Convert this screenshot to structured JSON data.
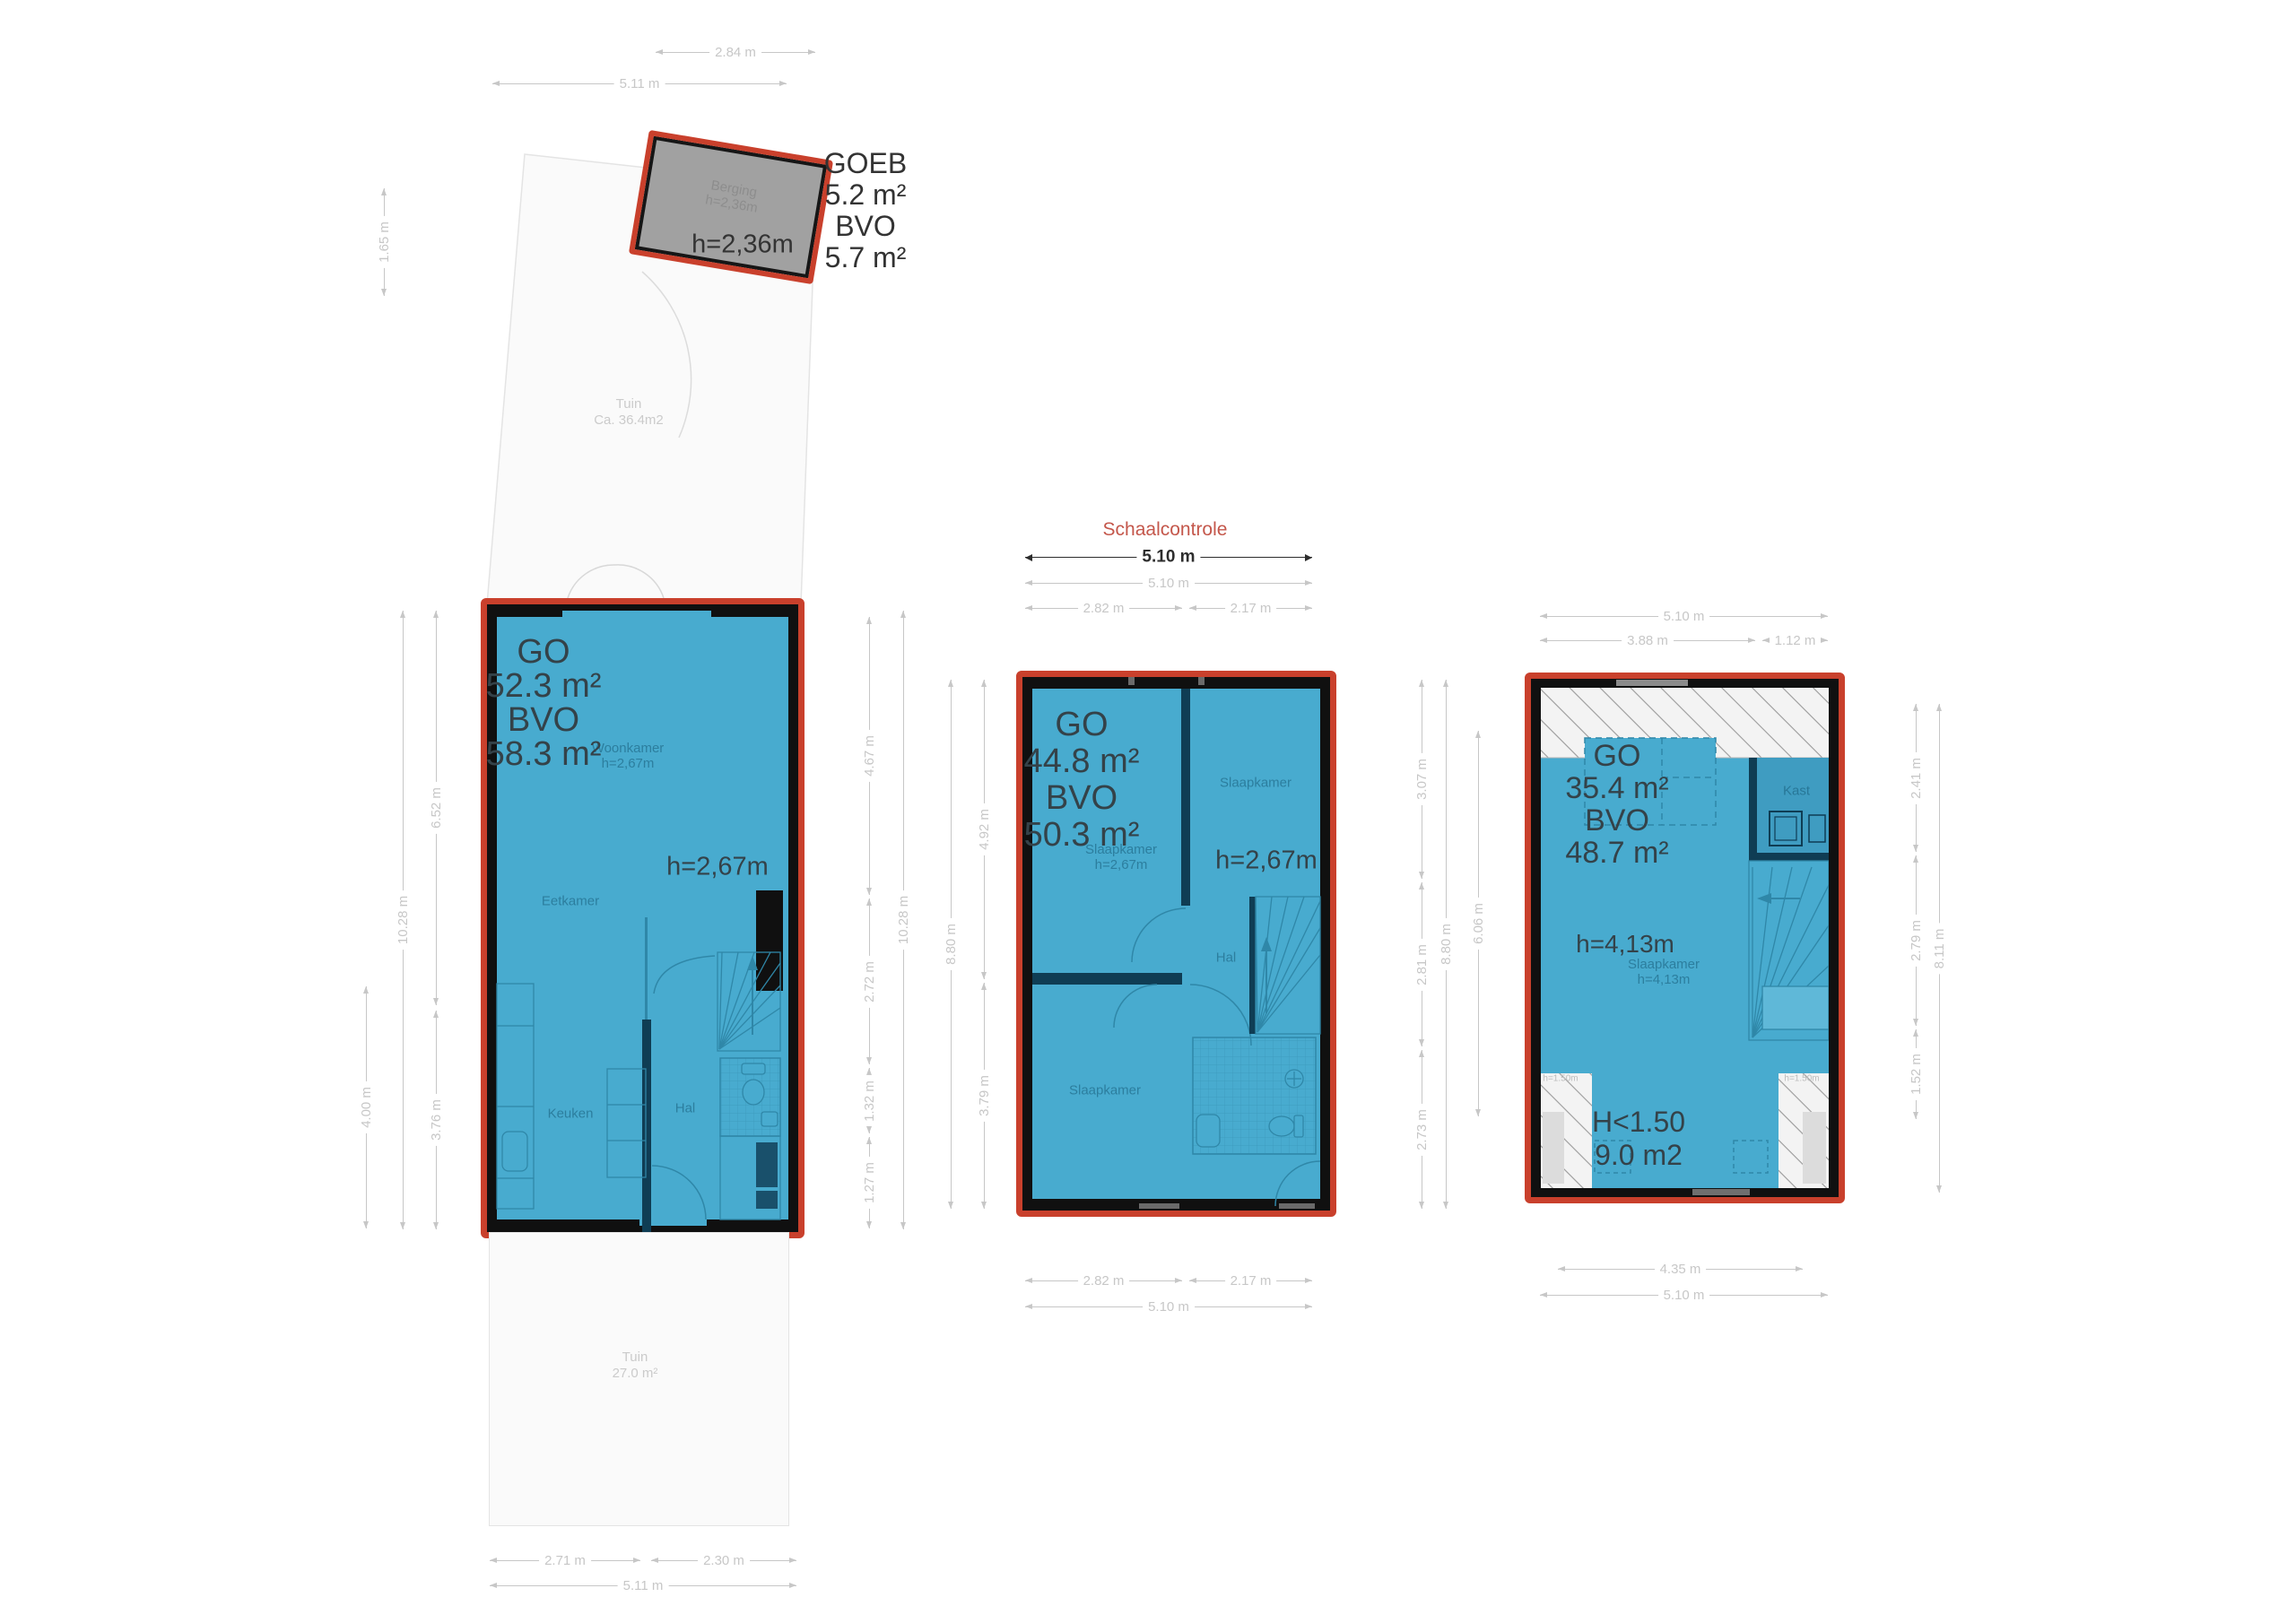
{
  "colors": {
    "plan_blue": "#48abcf",
    "outline_red": "#c9402c",
    "wall_black": "#101010",
    "dim_gray": "#c7c7c7",
    "label_dark": "#344249",
    "schaal_red": "#c4574b"
  },
  "shed": {
    "goeb_label": "GOEB",
    "goeb_area": "5.2 m²",
    "bvo_label": "BVO",
    "bvo_area": "5.7 m²",
    "height": "h=2,36m",
    "room_name": "Berging",
    "room_height": "h=2,36m"
  },
  "gardens": {
    "top_name": "Tuin",
    "top_area": "Ca. 36.4m2",
    "bottom_name": "Tuin",
    "bottom_area": "27.0 m²"
  },
  "scale_check": {
    "title": "Schaalcontrole"
  },
  "floors": {
    "ground": {
      "go_label": "GO",
      "go_area": "52.3 m²",
      "bvo_label": "BVO",
      "bvo_area": "58.3 m²",
      "height": "h=2,67m",
      "woonkamer": "Woonkamer",
      "woonkamer_h": "h=2,67m",
      "eetkamer": "Eetkamer",
      "keuken": "Keuken",
      "hal": "Hal"
    },
    "first": {
      "go_label": "GO",
      "go_area": "44.8 m²",
      "bvo_label": "BVO",
      "bvo_area": "50.3 m²",
      "height": "h=2,67m",
      "slaapkamer_top": "Slaapkamer",
      "slaapkamer_left": "Slaapkamer",
      "slaapkamer_left_h": "h=2,67m",
      "slaapkamer_bottom": "Slaapkamer",
      "hal": "Hal"
    },
    "attic": {
      "go_label": "GO",
      "go_area": "35.4 m²",
      "bvo_label": "BVO",
      "bvo_area": "48.7 m²",
      "height": "h=4,13m",
      "slaapkamer": "Slaapkamer",
      "slaapkamer_h": "h=4,13m",
      "kast": "Kast",
      "low_label": "H<1.50",
      "low_area": "9.0 m2",
      "hatch_left_label": "h=1.50m",
      "hatch_right_label": "h=1.50m"
    }
  },
  "dims": {
    "shed_w": "2.84 m",
    "shed_total_w": "5.11 m",
    "shed_h": "1.65 m",
    "g_left_a": "4.00 m",
    "g_left_full": "10.28 m",
    "g_left_top": "6.52 m",
    "g_left_bottom": "3.76 m",
    "g_right_s1": "4.67 m",
    "g_right_s2": "2.72 m",
    "g_right_s3": "1.32 m",
    "g_right_s4": "1.27 m",
    "g_right_full": "10.28 m",
    "g_bottom_a": "2.71 m",
    "g_bottom_b": "2.30 m",
    "g_bottom_full": "5.11 m",
    "f_scale": "5.10 m",
    "f_top_full": "5.10 m",
    "f_top_a": "2.82 m",
    "f_top_b": "2.17 m",
    "f_left_full": "8.80 m",
    "f_left_top": "4.92 m",
    "f_left_bottom": "3.79 m",
    "f_right_s1": "3.07 m",
    "f_right_s2": "2.81 m",
    "f_right_s3": "2.73 m",
    "f_right_full": "8.80 m",
    "f_bottom_a": "2.82 m",
    "f_bottom_b": "2.17 m",
    "f_bottom_full": "5.10 m",
    "a_left": "6.06 m",
    "a_top_full": "5.10 m",
    "a_top_a": "3.88 m",
    "a_top_b": "1.12 m",
    "a_right_s1": "2.41 m",
    "a_right_s2": "2.79 m",
    "a_right_s3": "1.52 m",
    "a_right_full": "8.11 m",
    "a_bottom_a": "4.35 m",
    "a_bottom_full": "5.10 m"
  }
}
